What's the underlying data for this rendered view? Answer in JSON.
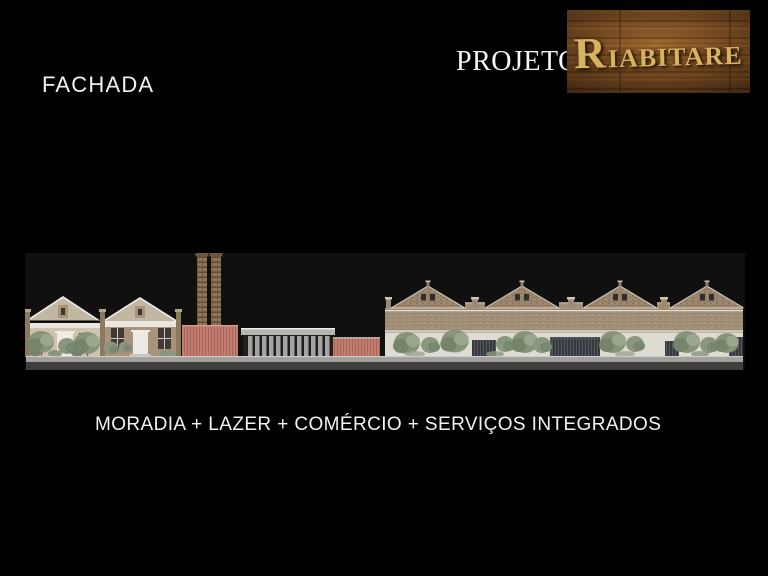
{
  "slide": {
    "title": "FACHADA",
    "project_label": "PROJETO",
    "logo_text": "RIABITARE",
    "caption": "MORADIA + LAZER + COMÉRCIO + SERVIÇOS INTEGRADOS"
  },
  "elevation": {
    "description": "Street facade elevation drawing: two gabled brick houses with trees, a red masonry wall with twin brick chimneys, a flat-roofed colonnade pavilion, a second red masonry wall, and a long industrial brick hall with four decorated gables, trees and dark slatted gates along a sidewalk."
  },
  "colors": {
    "slide_background": "#000000",
    "panel_background": "#101010",
    "text": "#f2f2f2",
    "logo_gold": "#d6b261",
    "logo_wood_brown": "#83502a",
    "terracotta_wall": "#c17d6f",
    "brick": "#a6937b",
    "gable_brick": "#9c8970",
    "roof_gray": "#c5bfb3",
    "white_wall": "#dedbd3",
    "foliage_green": "#87947a",
    "gate_gray": "#34383c",
    "sidewalk_gray": "#a3a19d"
  }
}
